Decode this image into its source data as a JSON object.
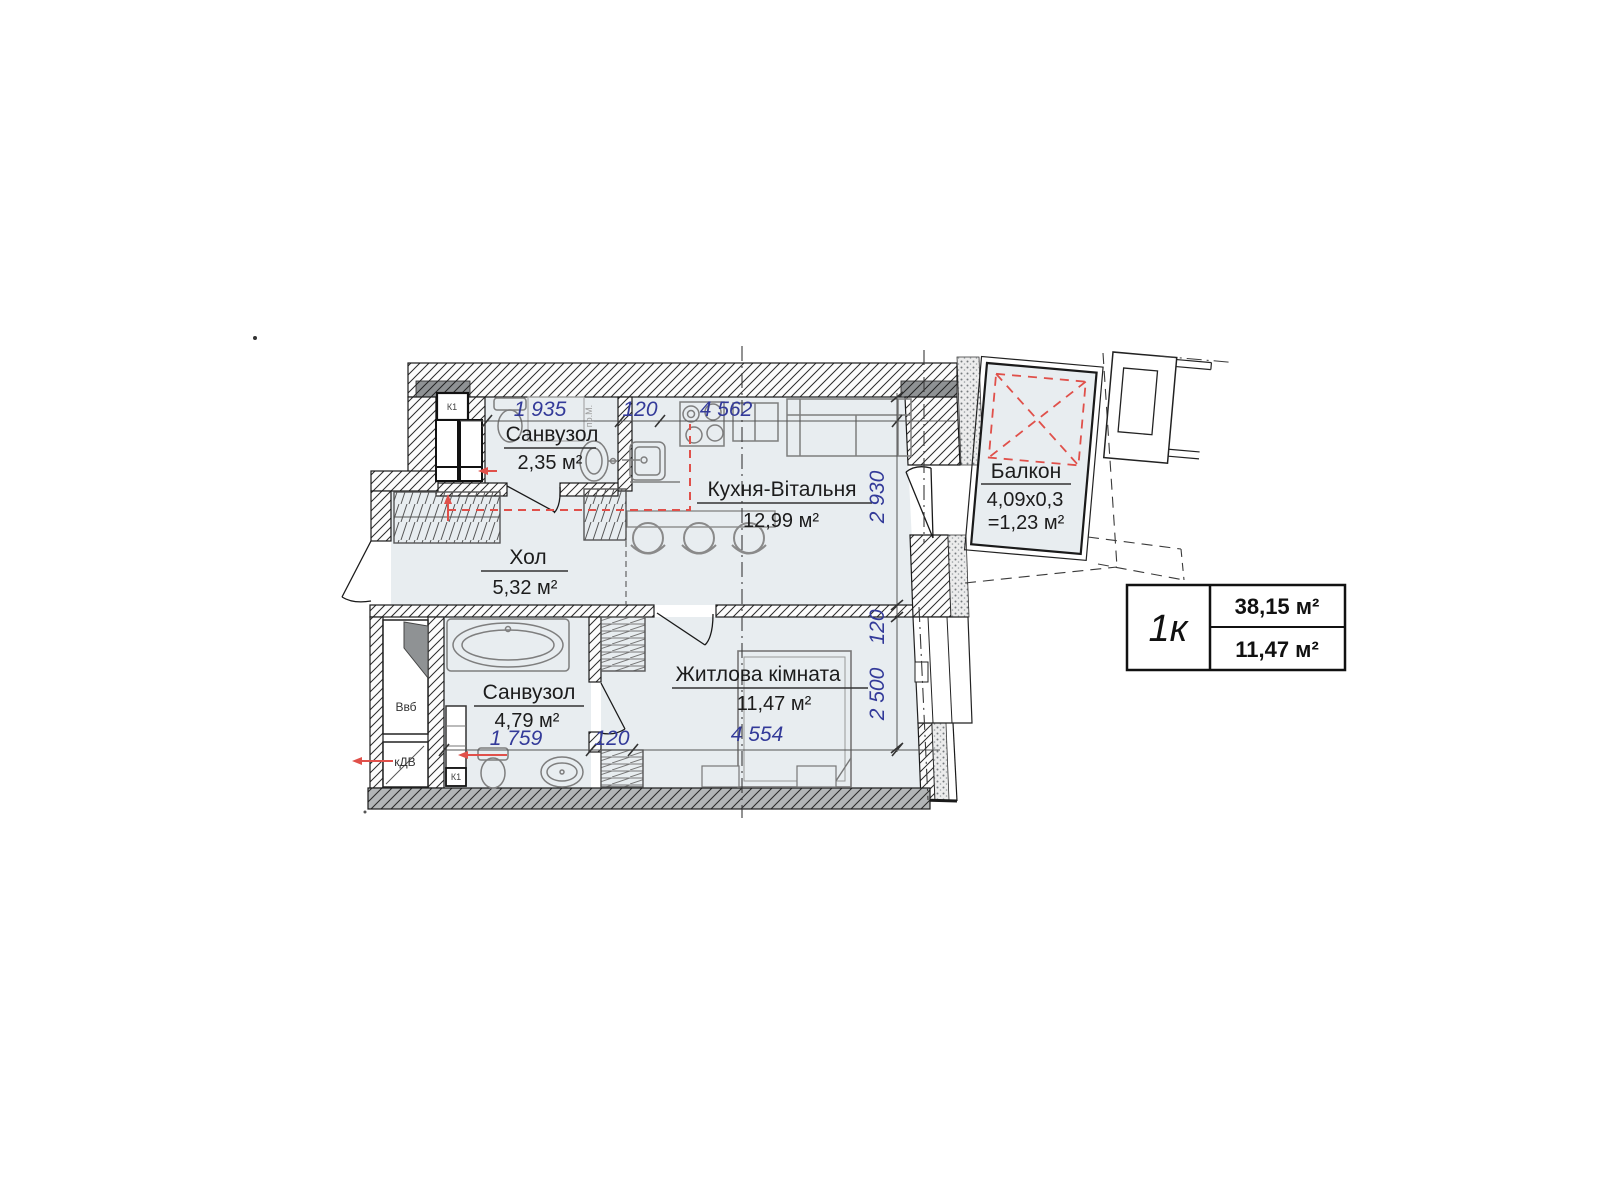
{
  "rooms": {
    "bathroom_top": {
      "name": "Санвузол",
      "area": "2,35 м²"
    },
    "kitchen": {
      "name": "Кухня-Вітальня",
      "area": "12,99 м²"
    },
    "hall": {
      "name": "Хол",
      "area": "5,32 м²"
    },
    "bathroom_bottom": {
      "name": "Санвузол",
      "area": "4,79 м²"
    },
    "bedroom": {
      "name": "Житлова кімната",
      "area": "11,47 м²"
    },
    "balcony": {
      "name": "Балкон",
      "size": "4,09х0,3",
      "area": "=1,23 м²"
    }
  },
  "dims": {
    "top": [
      "1 935",
      "120",
      "4 562"
    ],
    "right": [
      "2 930",
      "120",
      "2 500"
    ],
    "bottom": [
      "1 759",
      "120",
      "4 554"
    ]
  },
  "marks": {
    "k1": "К1",
    "vvb": "Ввб",
    "kdv": "кДВ",
    "washer": "пр.М."
  },
  "summary": {
    "type": "1к",
    "total_area": "38,15 м²",
    "living_area": "11,47 м²"
  },
  "colors": {
    "room_fill": "#e8edf0",
    "dim_blue": "#333a99",
    "annotation_red": "#e0504a",
    "wall_dark": "#8f9294",
    "wall_gray": "#b2b5b7"
  }
}
